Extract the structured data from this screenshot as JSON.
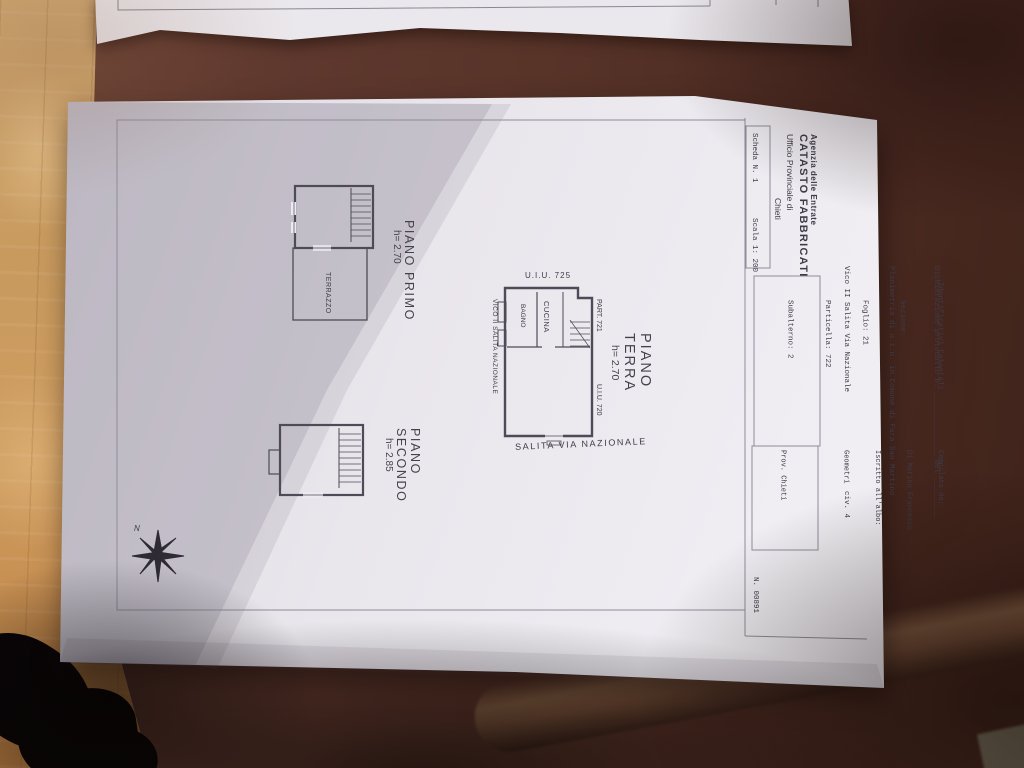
{
  "colors": {
    "paper": "#eceaf0",
    "paper_shadow": "#b9b3bf",
    "table_brown": "#573328",
    "floor_wood": "#c8945a",
    "ink": "#3e3b49"
  },
  "header": {
    "agency": {
      "line1": "Agenzia delle Entrate",
      "line2": "CATASTO FABBRICATI",
      "line3": "Ufficio Provinciale di",
      "line4": "Chieti"
    },
    "sheet_box": {
      "scheda": "Scheda N. 1",
      "scala": "Scala 1: 200"
    },
    "declaration": {
      "line1": "Dichiarazione protocollo n. ______________ del _________",
      "line2": "Planimetria di u.i.u. in Comune di Fara San Martino",
      "line3": "Vico II Salita Via Nazionale                      civ. 4"
    },
    "cadastral": {
      "title": "Identificativi Catastali.",
      "sezione": "    Sezione:",
      "foglio": "    Foglio: 21",
      "particella": "    Particella: 722",
      "subalterno": "    Subalterno: 2"
    },
    "compiler": {
      "line1": "Compilata da:",
      "line2": "Di Marino Francesco",
      "line3": "Iscritto all'albo:",
      "line4": "Geometri",
      "line5": " ",
      "line6": "Prov. Chieti"
    },
    "document_number": "N. 00891"
  },
  "plans": {
    "piano_terra": {
      "title": "PIANO TERRA",
      "height": "h= 2.70",
      "uiu_top": "U.I.U. 725",
      "part_label": "PART. 721",
      "uiu_side": "U.I.U. 720",
      "street_left": "VICO II SALITA NAZIONALE",
      "street_bottom": "SALITA VIA NAZIONALE",
      "room_bagno": "BAGNO",
      "room_cucina": "CUCINA"
    },
    "piano_primo": {
      "title": "PIANO PRIMO",
      "height": "h= 2.70",
      "room_terrazzo": "TERRAZZO"
    },
    "piano_secondo": {
      "title": "PIANO SECONDO",
      "height": "h= 2.85"
    },
    "compass_label": "N"
  }
}
